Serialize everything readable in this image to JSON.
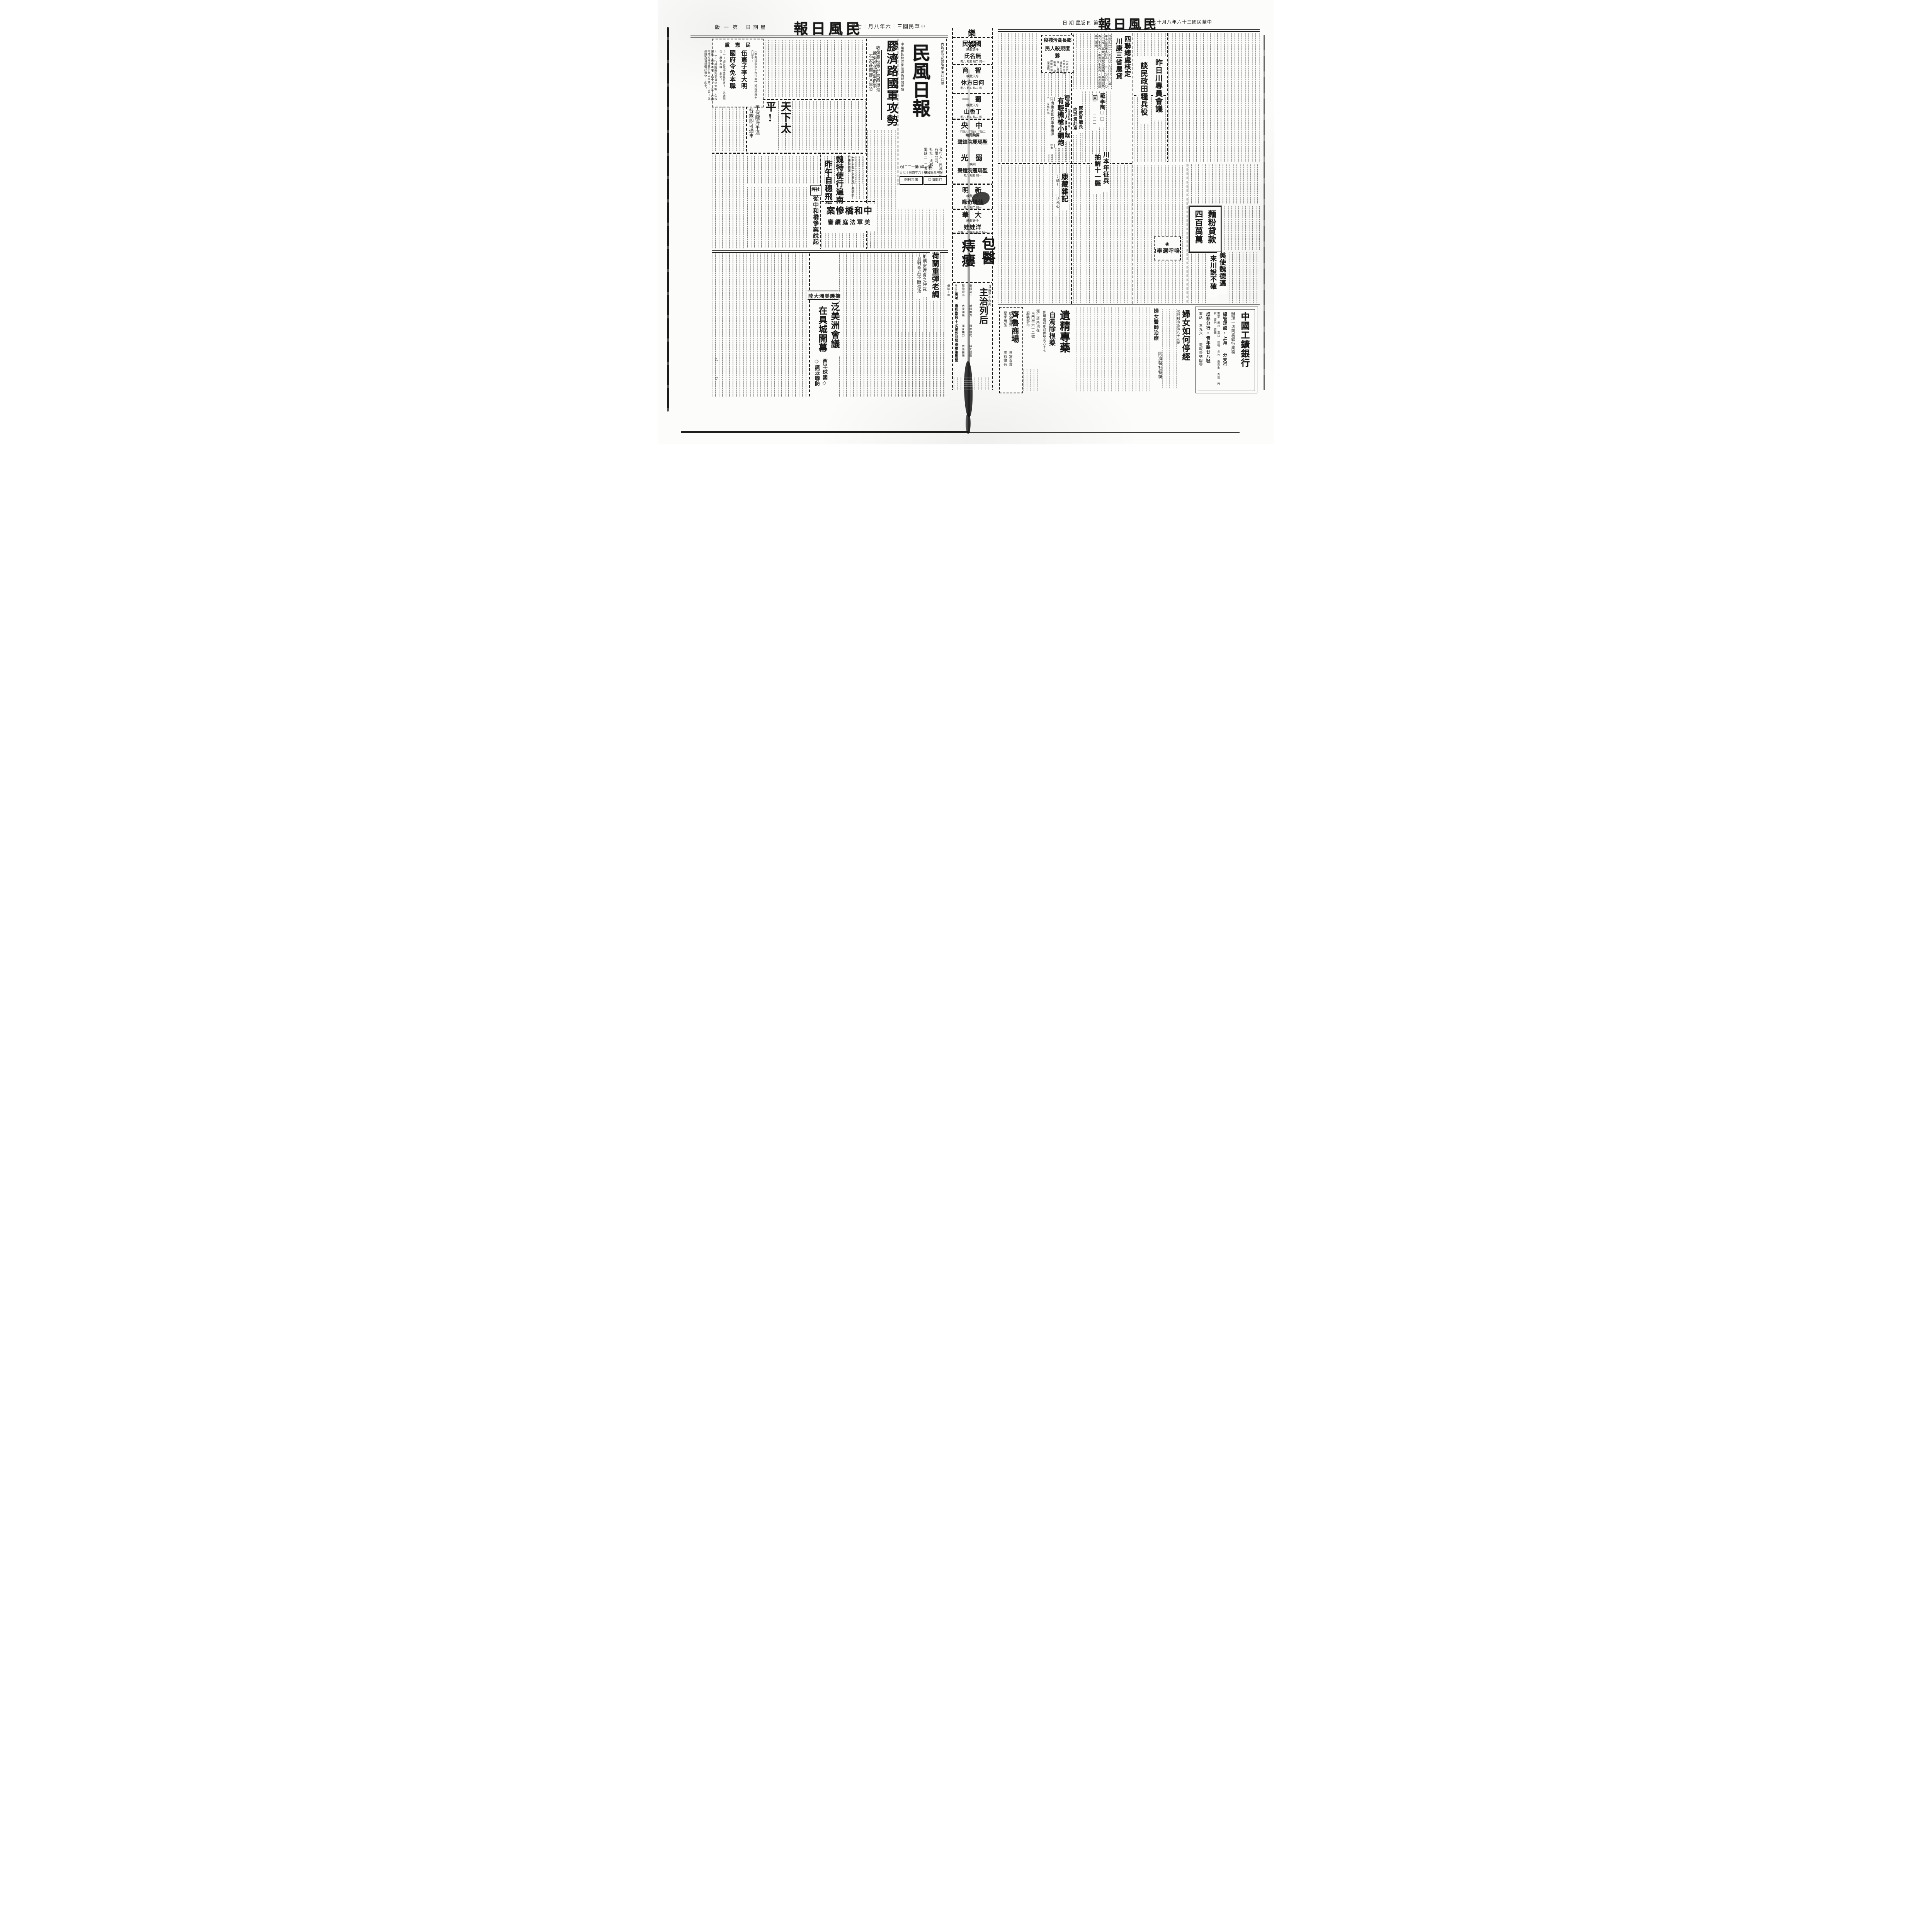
{
  "header_left": {
    "edition": "第一版",
    "weekday": "星期日",
    "title": "民風日報",
    "date": "中華民國三十六年八月十七日"
  },
  "header_right": {
    "edition": "第四版",
    "weekday": "星期日",
    "title": "民風日報",
    "date": "中華民國三十六年八月十七日"
  },
  "left_page": {
    "decree_box": {
      "kicker": "民憲黨",
      "lead": "【中央社南京十六日電】國民政府十六日令:",
      "head1": "伍憲子李大明",
      "head2": "國府令免本職",
      "body1": "(一)國民政府委員伍憲子,久未到任,應免本職,此令。",
      "body2": "(二)行政院政務委員李大明,久未到任,應免本職,此令。(三)首都衛戍司令湯恩伯免去本職。(四)派張鎮為首都衛戍司令,此令。"
    },
    "taiping": {
      "head": "天下太平!",
      "sub1": "平保隴海平漢",
      "sub2": "各線即可通車"
    },
    "wei": {
      "lead": "【中央社十六日電】美總統特使魏德邁",
      "head1": "魏特使行遍南北",
      "head2": "昨午自穗飛返京"
    },
    "editorial": {
      "label": "社評",
      "head": "從中和橋慘案說起"
    },
    "bridge": {
      "head": "中和橋慘案",
      "sub": "美軍法庭續審"
    },
    "holland": {
      "head": "荷蘭重彈老調",
      "sub1": "拒絕安理會之仲裁",
      "sub2": "且對傘兵不斷進攻"
    },
    "panam": {
      "kicker": "擁護美洲大陸",
      "head1": "泛美洲會議",
      "head2": "在具城開幕",
      "sub1": "西半球國◇",
      "sub2": "◇廣泛聯防"
    },
    "marks": {
      "m1": "△",
      "m2": "▽"
    },
    "jiaoji": {
      "head": "膠濟路國軍攻勢",
      "sub": "收復高密章邱向西挺進",
      "kicker1": "豫東皖北戰事仍緊",
      "kicker2": "石家莊東部又告急"
    },
    "nameplate": {
      "reg_right": "內政部登記證警字第□□號",
      "title": "民風日報",
      "reg_left": "中華郵政特准掛號認為新聞紙類",
      "publisher": "發行人・民風報股份有限公司",
      "address": "社址・成都□□街",
      "phone": "電話二一二五號",
      "issue": "(第一年)(第一二二號)",
      "founded": "中華民國三十六年四月十七日",
      "box1": "廣告刊例",
      "box2": "訂閱價目"
    }
  },
  "center": {
    "section": "娛樂",
    "listings": [
      {
        "theater": "國民",
        "note": "今天獻映",
        "film": "無名氏",
        "times": "一點 二點 五點 八點"
      },
      {
        "theater": "智育",
        "note": "今天獻映",
        "film": "何日方休",
        "times": "一點 二點 五點 八點"
      },
      {
        "theater": "蜀一",
        "note": "今天獻映",
        "film": "丁香山",
        "times": "一點 二點 五點 八點"
      },
      {
        "theater": "中央",
        "note": "兩院同映",
        "film": "聖瑪麗院鐘聲",
        "times": "二點半 五點半 八點半"
      },
      {
        "theater": "蜀光",
        "note": "同映",
        "film": "聖瑪麗院鐘聲",
        "times": "一點 五點 八點"
      },
      {
        "theater": "新明",
        "note": "今天獻映",
        "film": "仙境奇緣",
        "times": "一點 二點 八點"
      },
      {
        "theater": "大華",
        "note": "今天獻映",
        "film": "洋娃娃",
        "times": "一點 二點 五點半 八點半"
      }
    ],
    "medical_ad": {
      "head1": "包醫",
      "head2": "痔瘻",
      "sub": "主治列后",
      "note": "且壽亦不永矣",
      "symptoms": [
        "遺精盜汗",
        "射精無力",
        "頭暈眼花",
        "婦女陰痿",
        "陽物短小",
        "房後頭痛",
        "渾身無力",
        "房後腹痛",
        "陰深不孕",
        "所列各症",
        "限日全愈",
        "不愈退費",
        "保險十年"
      ],
      "address": "地址 春熙南段十七號公益智茶樓後隔壁"
    }
  },
  "right_page": {
    "nongdai": {
      "head1": "四聯總處核定",
      "head2": "川康三省農貸",
      "body": "總計七一二,七〇〇,〇〇〇元,其中小型農田水利為一一二,七〇〇,〇〇〇元,農業生產為三億元,農村副業為六千萬元,推廣四千萬元,農產運銷為二億元。"
    },
    "xiang": {
      "head1": "鄉長貪污殘殺",
      "head2": "夥匪規殺人民",
      "lead": "【新元社】奉節馮坪鄉鄉長向世澤,貪污吸毒,經該鄉民眾檢舉撤職。"
    },
    "meeting": {
      "head1": "昨日川專員會議",
      "head2": "談民政田糧兵役"
    },
    "dai": {
      "head1": "戴季陶□□",
      "head2": "回□□□□"
    },
    "lifan": {
      "kicker": "出重金延聘軍事指揮",
      "head1": "理番夷人將惡戰",
      "head2": "有輕機槍小鋼炮",
      "lead": "【□□社】理番通訊:此間後番堯波夷人,文化低落"
    },
    "kangedu": {
      "head1": "康教育廳長",
      "head2": "向理潤赴京",
      "lead": "【康藏社】康定"
    },
    "zhengbing": {
      "head1": "川本年征兵",
      "head2": "抽解十一縣"
    },
    "kangzang": {
      "head": "康藏雜記",
      "cont": "(續)",
      "author": "□光心"
    },
    "mianfen": {
      "head1": "麵粉貸款",
      "head2": "四百萬萬"
    },
    "wuhu": {
      "icon": "◉",
      "head": "嗚呼選舉!"
    },
    "weidemai": {
      "head1": "美使魏德邁",
      "head2": "來川說不確"
    },
    "ads": {
      "qilu": {
        "name": "齊魯商場",
        "line1": "航空運到",
        "line2": "夏季用品",
        "line3": "日常百貨",
        "line4": "應有盡有"
      },
      "daosheng": {
        "line1": "道生診所現在",
        "line2": "南門街六十二號",
        "line3": "服裝部內"
      },
      "yijing": {
        "head": "遺精專藥",
        "sub": "白濁除根藥",
        "address": "郵購處成都紅照壁街六十七"
      },
      "funu": {
        "head": "婦女如何停經",
        "doctor": "婦女醫師治療",
        "clinic": "同濟醫社特聘",
        "address": "忠烈祠南街第八十三號"
      },
      "bank": {
        "name": "中國工鑛銀行",
        "services": "辦理一切商業銀行業務",
        "hq": "總管理處:上海",
        "branches_label": "分支行",
        "branches": "南京 廣州 漢口 昆明 長沙 自貢市 青島 西安 廈門 寶雞",
        "chengdu": "成都分行:青年路廿八號",
        "phone": "電話 三九六",
        "cable": "電報掛號四零"
      }
    }
  }
}
